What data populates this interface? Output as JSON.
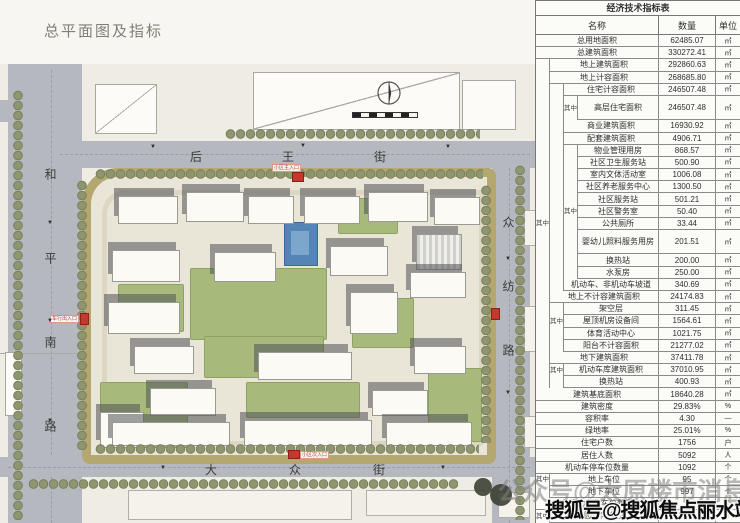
{
  "page": {
    "title": "总平面图及指标"
  },
  "plan": {
    "streets": {
      "top": "后王街",
      "bottom": "大众街",
      "left": "和平南路",
      "right": "众纺路"
    },
    "entrances": {
      "main": "小区主入口",
      "secondary": "小区次入口",
      "vehicle_left": "车行出入口",
      "vehicle_right": "车行出入口"
    },
    "icons": {
      "compass": "north-compass",
      "scale": "scale-bar"
    },
    "colors": {
      "road": "#b5b8bf",
      "site_band": "#b4a870",
      "lawn": "#a7ba7c",
      "water": "#5585b5",
      "building": "#fbfaf4",
      "shadow": "#50525880",
      "tree": "#8e956f",
      "entrance_red": "#c4392f"
    }
  },
  "table": {
    "title": "经济技术指标表",
    "columns": [
      "名称",
      "数量",
      "单位"
    ],
    "rows": [
      {
        "n": "总用地面积",
        "v": "62485.07",
        "u": "㎡",
        "ind": 0
      },
      {
        "n": "总建筑面积",
        "v": "330272.41",
        "u": "㎡",
        "ind": 0
      },
      {
        "n": "地上建筑面积",
        "v": "292860.63",
        "u": "㎡",
        "ind": 1
      },
      {
        "n": "地上计容面积",
        "v": "268685.80",
        "u": "㎡",
        "ind": 1
      },
      {
        "n": "住宅计容面积",
        "v": "246507.48",
        "u": "㎡",
        "ind": 2
      },
      {
        "n": "高层住宅面积",
        "v": "246507.48",
        "u": "㎡",
        "ind": 3,
        "g": "其中",
        "gs": 2,
        "h": 2
      },
      {
        "n": "商业建筑面积",
        "v": "16930.92",
        "u": "㎡",
        "ind": 2
      },
      {
        "n": "配套建筑面积",
        "v": "4906.71",
        "u": "㎡",
        "ind": 2
      },
      {
        "n": "物业管理用房",
        "v": "868.57",
        "u": "㎡",
        "ind": 3
      },
      {
        "n": "社区卫生服务站",
        "v": "500.90",
        "u": "㎡",
        "ind": 3
      },
      {
        "n": "室内文体活动室",
        "v": "1006.08",
        "u": "㎡",
        "ind": 3
      },
      {
        "n": "社区养老服务中心",
        "v": "1300.50",
        "u": "㎡",
        "ind": 3
      },
      {
        "n": "社区服务站",
        "v": "501.21",
        "u": "㎡",
        "ind": 3
      },
      {
        "n": "社区警务室",
        "v": "50.40",
        "u": "㎡",
        "ind": 3,
        "g": "其中",
        "gs": 2
      },
      {
        "n": "公共厕所",
        "v": "33.44",
        "u": "㎡",
        "ind": 3,
        "g": "其中",
        "gs": 0
      },
      {
        "n": "婴幼儿照料服务用房",
        "v": "201.51",
        "u": "㎡",
        "ind": 3,
        "h": 2
      },
      {
        "n": "换热站",
        "v": "200.00",
        "u": "㎡",
        "ind": 3
      },
      {
        "n": "水泵房",
        "v": "250.00",
        "u": "㎡",
        "ind": 3
      },
      {
        "n": "机动车、非机动车坡道",
        "v": "340.69",
        "u": "㎡",
        "ind": 2
      },
      {
        "n": "地上不计容建筑面积",
        "v": "24174.83",
        "u": "㎡",
        "ind": 1
      },
      {
        "n": "架空层",
        "v": "311.45",
        "u": "㎡",
        "ind": 2
      },
      {
        "n": "屋顶机房设备间",
        "v": "1564.61",
        "u": "㎡",
        "ind": 2,
        "g": "其中",
        "gs": 1
      },
      {
        "n": "体育活动中心",
        "v": "1021.75",
        "u": "㎡",
        "ind": 2
      },
      {
        "n": "阳台不计容面积",
        "v": "21277.02",
        "u": "㎡",
        "ind": 2
      },
      {
        "n": "地下建筑面积",
        "v": "37411.78",
        "u": "㎡",
        "ind": 1
      },
      {
        "n": "机动车库建筑面积",
        "v": "37010.95",
        "u": "㎡",
        "ind": 2,
        "g": "其中",
        "gs": 1
      },
      {
        "n": "换热站",
        "v": "400.93",
        "u": "㎡",
        "ind": 2
      },
      {
        "n": "建筑基底面积",
        "v": "18640.28",
        "u": "㎡",
        "ind": 0
      },
      {
        "n": "建筑密度",
        "v": "29.83%",
        "u": "%",
        "ind": 0
      },
      {
        "n": "容积率",
        "v": "4.30",
        "u": "—",
        "ind": 0
      },
      {
        "n": "绿地率",
        "v": "25.01%",
        "u": "%",
        "ind": 0
      },
      {
        "n": "住宅户数",
        "v": "1756",
        "u": "户",
        "ind": 0
      },
      {
        "n": "居住人数",
        "v": "5092",
        "u": "人",
        "ind": 0
      },
      {
        "n": "机动车停车位数量",
        "v": "1092",
        "u": "个",
        "ind": 0
      },
      {
        "n": "地上车位",
        "v": "95",
        "u": "个",
        "ind": 1,
        "g": "其中",
        "gs": 0
      },
      {
        "n": "地下车位",
        "v": "997",
        "u": "个",
        "ind": 1
      },
      {
        "n": "非机动车停车位数量",
        "v": "",
        "u": "个",
        "ind": 0
      },
      {
        "n": "园地内车位",
        "v": "1039",
        "u": "个",
        "ind": 1,
        "g": "其中",
        "gs": 0
      }
    ]
  },
  "watermarks": {
    "gray": "公众号@太原楼市消息",
    "black": "搜狐号@搜狐焦点丽水站"
  }
}
